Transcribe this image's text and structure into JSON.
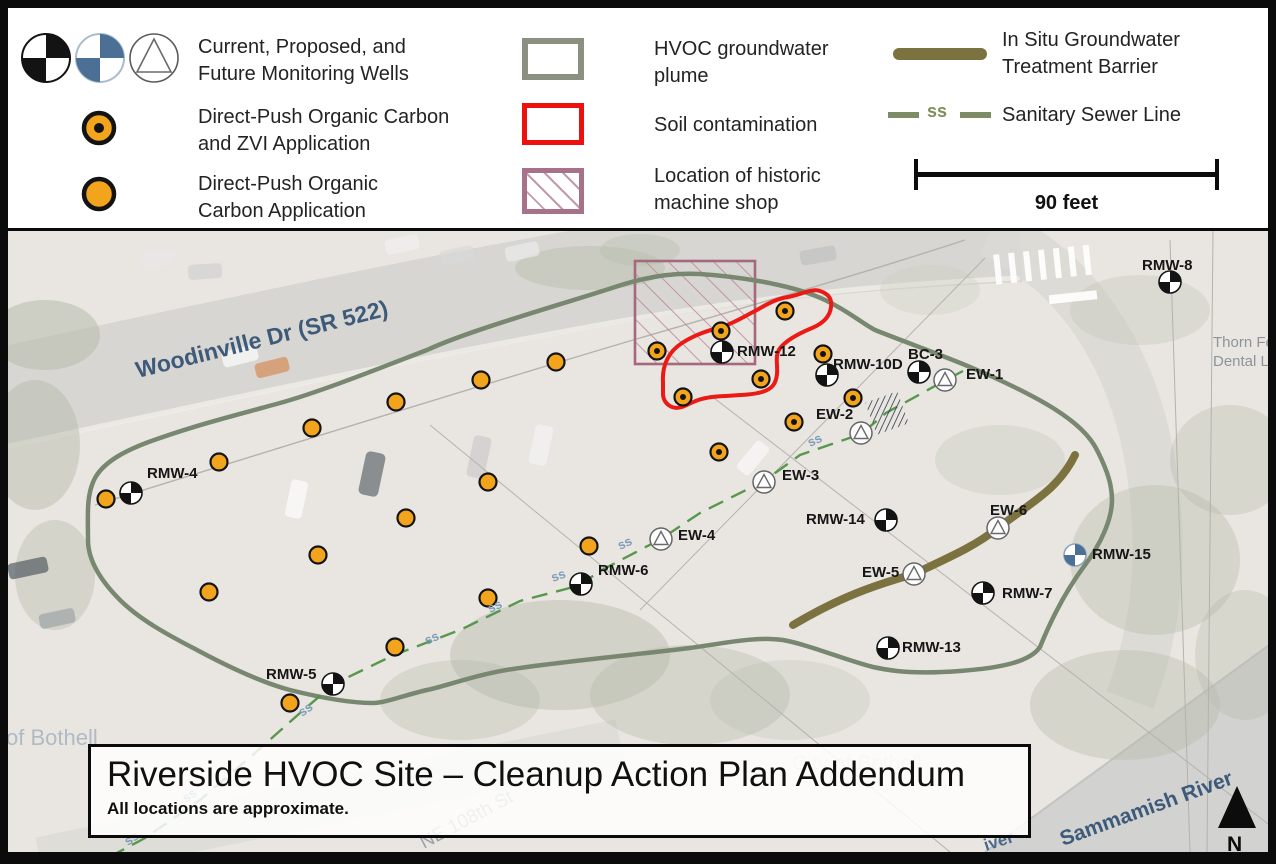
{
  "colors": {
    "orange": "#F2A41C",
    "well_black": "#131313",
    "well_blue": "#4C6F96",
    "plume_outline": "#78876F",
    "soil_red": "#EC1A14",
    "machine_shop": "#A5687E",
    "machine_shop_hatch": "#BB8C9D",
    "barrier_olive": "#7B7240",
    "sewer_green": "#4F9445",
    "ss_label": "#7F9CBA"
  },
  "legend": {
    "monitoring_wells": {
      "line1": "Current, Proposed, and",
      "line2": "Future Monitoring Wells"
    },
    "zvi": {
      "line1": "Direct-Push Organic Carbon",
      "line2": "and ZVI Application"
    },
    "carbon": {
      "line1": "Direct-Push Organic",
      "line2": "Carbon Application"
    },
    "plume": {
      "line1": "HVOC groundwater",
      "line2": "plume"
    },
    "soil": {
      "line1": "Soil contamination"
    },
    "machine_shop": {
      "line1": "Location of historic",
      "line2": "machine shop"
    },
    "barrier": {
      "line1": "In Situ Groundwater",
      "line2": "Treatment Barrier"
    },
    "sewer": {
      "label": "Sanitary Sewer Line",
      "ss": "ss"
    },
    "scale_bar": {
      "label": "90 feet"
    }
  },
  "title_box": {
    "title": "Riverside HVOC Site – Cleanup Action Plan Addendum",
    "subtitle": "All locations are approximate."
  },
  "map": {
    "north_label": "N",
    "ss_text": "ss",
    "labels": [
      {
        "id": "woodinville-dr",
        "text": "Woodinville Dr (SR 522)",
        "x": 138,
        "y": 378,
        "rotate": -14,
        "size": 23,
        "color": "#3D5A7A",
        "weight": "600"
      },
      {
        "id": "sammamish-river",
        "text": "Sammamish River",
        "x": 1063,
        "y": 846,
        "rotate": -20,
        "size": 21,
        "color": "#3D5A7A",
        "weight": "600"
      },
      {
        "id": "river-fragment",
        "text": "iver",
        "x": 986,
        "y": 851,
        "rotate": -18,
        "size": 17,
        "color": "#4C6B8C",
        "weight": "600"
      },
      {
        "id": "ne-108th-st",
        "text": "NE 108th St",
        "x": 424,
        "y": 849,
        "rotate": -28,
        "size": 19,
        "color": "#9BA1A6",
        "weight": "400"
      },
      {
        "id": "city-of-bothell",
        "text": "City of Bothell",
        "x": 792,
        "y": 770,
        "rotate": 0,
        "size": 21,
        "color": "#C6CCD0",
        "weight": "400"
      },
      {
        "id": "of-bothell",
        "text": "of Bothell",
        "x": 6,
        "y": 745,
        "rotate": 0,
        "size": 22,
        "color": "#AFBAC3",
        "weight": "400"
      },
      {
        "id": "thorn-dental-line1",
        "text": "Thorn Fe",
        "x": 1213,
        "y": 347,
        "rotate": 0,
        "size": 15,
        "color": "#8E9499",
        "weight": "400"
      },
      {
        "id": "thorn-dental-line2",
        "text": "Dental L",
        "x": 1213,
        "y": 366,
        "rotate": 0,
        "size": 15,
        "color": "#8E9499",
        "weight": "400"
      }
    ],
    "wells": [
      {
        "id": "RMW-4",
        "type": "current",
        "x": 131,
        "y": 493,
        "label": "RMW-4",
        "lx": 147,
        "ly": 478
      },
      {
        "id": "RMW-5",
        "type": "current",
        "x": 333,
        "y": 684,
        "label": "RMW-5",
        "lx": 266,
        "ly": 679
      },
      {
        "id": "RMW-6",
        "type": "current",
        "x": 581,
        "y": 584,
        "label": "RMW-6",
        "lx": 598,
        "ly": 575
      },
      {
        "id": "RMW-7",
        "type": "current",
        "x": 983,
        "y": 593,
        "label": "RMW-7",
        "lx": 1002,
        "ly": 598
      },
      {
        "id": "RMW-8",
        "type": "current",
        "x": 1170,
        "y": 282,
        "label": "RMW-8",
        "lx": 1142,
        "ly": 270
      },
      {
        "id": "RMW-12",
        "type": "current",
        "x": 722,
        "y": 352,
        "label": "RMW-12",
        "lx": 737,
        "ly": 356
      },
      {
        "id": "RMW-13",
        "type": "current",
        "x": 888,
        "y": 648,
        "label": "RMW-13",
        "lx": 902,
        "ly": 652
      },
      {
        "id": "RMW-14",
        "type": "current",
        "x": 886,
        "y": 520,
        "label": "RMW-14",
        "lx": 806,
        "ly": 524
      },
      {
        "id": "RMW-10D",
        "type": "current",
        "x": 827,
        "y": 375,
        "label": "RMW-10D",
        "lx": 833,
        "ly": 369
      },
      {
        "id": "BC-3",
        "type": "current",
        "x": 919,
        "y": 372,
        "label": "BC-3",
        "lx": 908,
        "ly": 359
      },
      {
        "id": "RMW-15",
        "type": "proposed",
        "x": 1075,
        "y": 555,
        "label": "RMW-15",
        "lx": 1092,
        "ly": 559
      },
      {
        "id": "EW-1",
        "type": "future",
        "x": 945,
        "y": 380,
        "label": "EW-1",
        "lx": 966,
        "ly": 379
      },
      {
        "id": "EW-2",
        "type": "future",
        "x": 861,
        "y": 433,
        "label": "EW-2",
        "lx": 816,
        "ly": 419
      },
      {
        "id": "EW-3",
        "type": "future",
        "x": 764,
        "y": 482,
        "label": "EW-3",
        "lx": 782,
        "ly": 480
      },
      {
        "id": "EW-4",
        "type": "future",
        "x": 661,
        "y": 539,
        "label": "EW-4",
        "lx": 678,
        "ly": 540
      },
      {
        "id": "EW-5",
        "type": "future",
        "x": 914,
        "y": 574,
        "label": "EW-5",
        "lx": 862,
        "ly": 577
      },
      {
        "id": "EW-6",
        "type": "future",
        "x": 998,
        "y": 528,
        "label": "EW-6",
        "lx": 990,
        "ly": 515
      }
    ],
    "zvi_points": [
      [
        657,
        351
      ],
      [
        721,
        331
      ],
      [
        785,
        311
      ],
      [
        823,
        354
      ],
      [
        761,
        379
      ],
      [
        683,
        397
      ],
      [
        853,
        398
      ],
      [
        794,
        422
      ],
      [
        719,
        452
      ]
    ],
    "carbon_points": [
      [
        106,
        499
      ],
      [
        219,
        462
      ],
      [
        312,
        428
      ],
      [
        396,
        402
      ],
      [
        481,
        380
      ],
      [
        556,
        362
      ],
      [
        488,
        482
      ],
      [
        406,
        518
      ],
      [
        318,
        555
      ],
      [
        209,
        592
      ],
      [
        589,
        546
      ],
      [
        488,
        598
      ],
      [
        395,
        647
      ],
      [
        290,
        703
      ]
    ],
    "ss_labels": [
      [
        810,
        447,
        -25
      ],
      [
        620,
        550,
        -25
      ],
      [
        553,
        582,
        -20
      ],
      [
        490,
        613,
        -25
      ],
      [
        427,
        645,
        -25
      ],
      [
        302,
        717,
        -35
      ],
      [
        186,
        803,
        -35
      ],
      [
        128,
        846,
        -35
      ]
    ]
  }
}
